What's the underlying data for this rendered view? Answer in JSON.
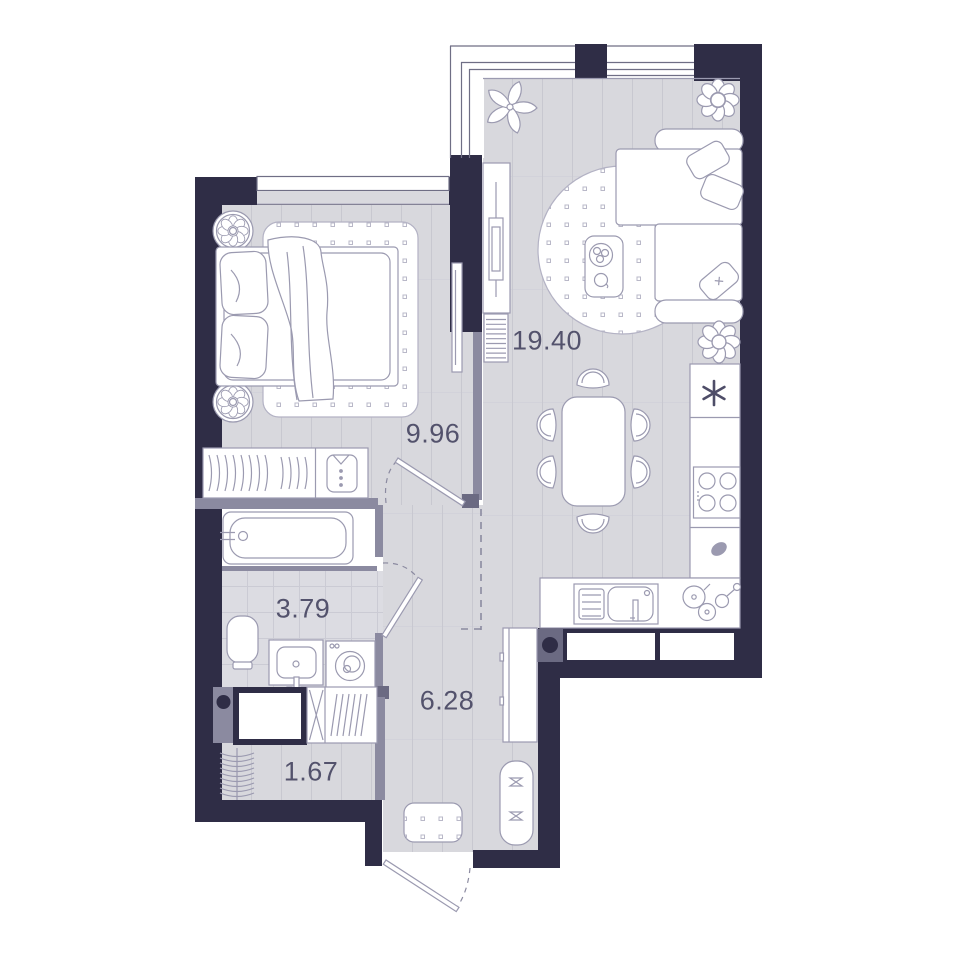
{
  "rooms": [
    {
      "name": "living-kitchen",
      "area": "19.40"
    },
    {
      "name": "bedroom",
      "area": "9.96"
    },
    {
      "name": "bathroom",
      "area": "3.79"
    },
    {
      "name": "hallway",
      "area": "6.28"
    },
    {
      "name": "wardrobe",
      "area": "1.67"
    }
  ],
  "colors": {
    "wall": "#2f2d46",
    "partition": "#8b8aa0",
    "partition_dark": "#6b6a82",
    "floor": "#d8d8dd",
    "floor_line": "#c8c8d0",
    "tile": "#dcdce2",
    "tile_line": "#cbcbd4",
    "furniture_outline": "#9b9ab0",
    "label_text": "#53526c"
  }
}
